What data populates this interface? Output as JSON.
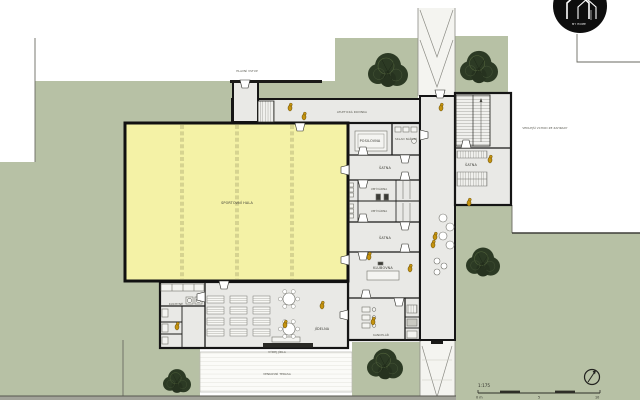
{
  "plan": {
    "type": "architectural floor plan",
    "scale_note": "1:175"
  },
  "colors": {
    "lawn": "#b7c1a5",
    "hall_fill": "#f4f2a6",
    "floor": "#e9e9e6",
    "wall": "#151515",
    "tree": "#2c3a24",
    "person": "#c6940f",
    "logo_bg": "#0e0e0e"
  },
  "labels": {
    "logo_text": "MY HOME",
    "main_entrance": "HLAVNÍ VSTUP",
    "track": "ATLETICKÁ ROVINKA",
    "side_entrance": "VEDLEJŠÍ VCHOD ZE ZAHRADY",
    "hall": "SPORTOVNÍ HALA",
    "fitness": "POSILOVNA",
    "storage": "SKLAD NÁŘADÍ",
    "locker_a": "ŠATNA",
    "wash_a": "UMÝVÁRNA",
    "wash_b": "UMÝVÁRNA",
    "locker_b": "ŠATNA",
    "club": "KLUBOVNA",
    "office": "KANCELÁŘ",
    "bike_room": "ŠATNA",
    "kitchen": "KUCHYNĚ",
    "dining": "JÍDELNA",
    "serving": "VÝDEJ JÍDLA",
    "terrace": "VENKOVNÍ TERASA",
    "scale_ratio": "1:175",
    "scale_zero": "0 m",
    "scale_five": "5",
    "scale_ten": "10"
  }
}
